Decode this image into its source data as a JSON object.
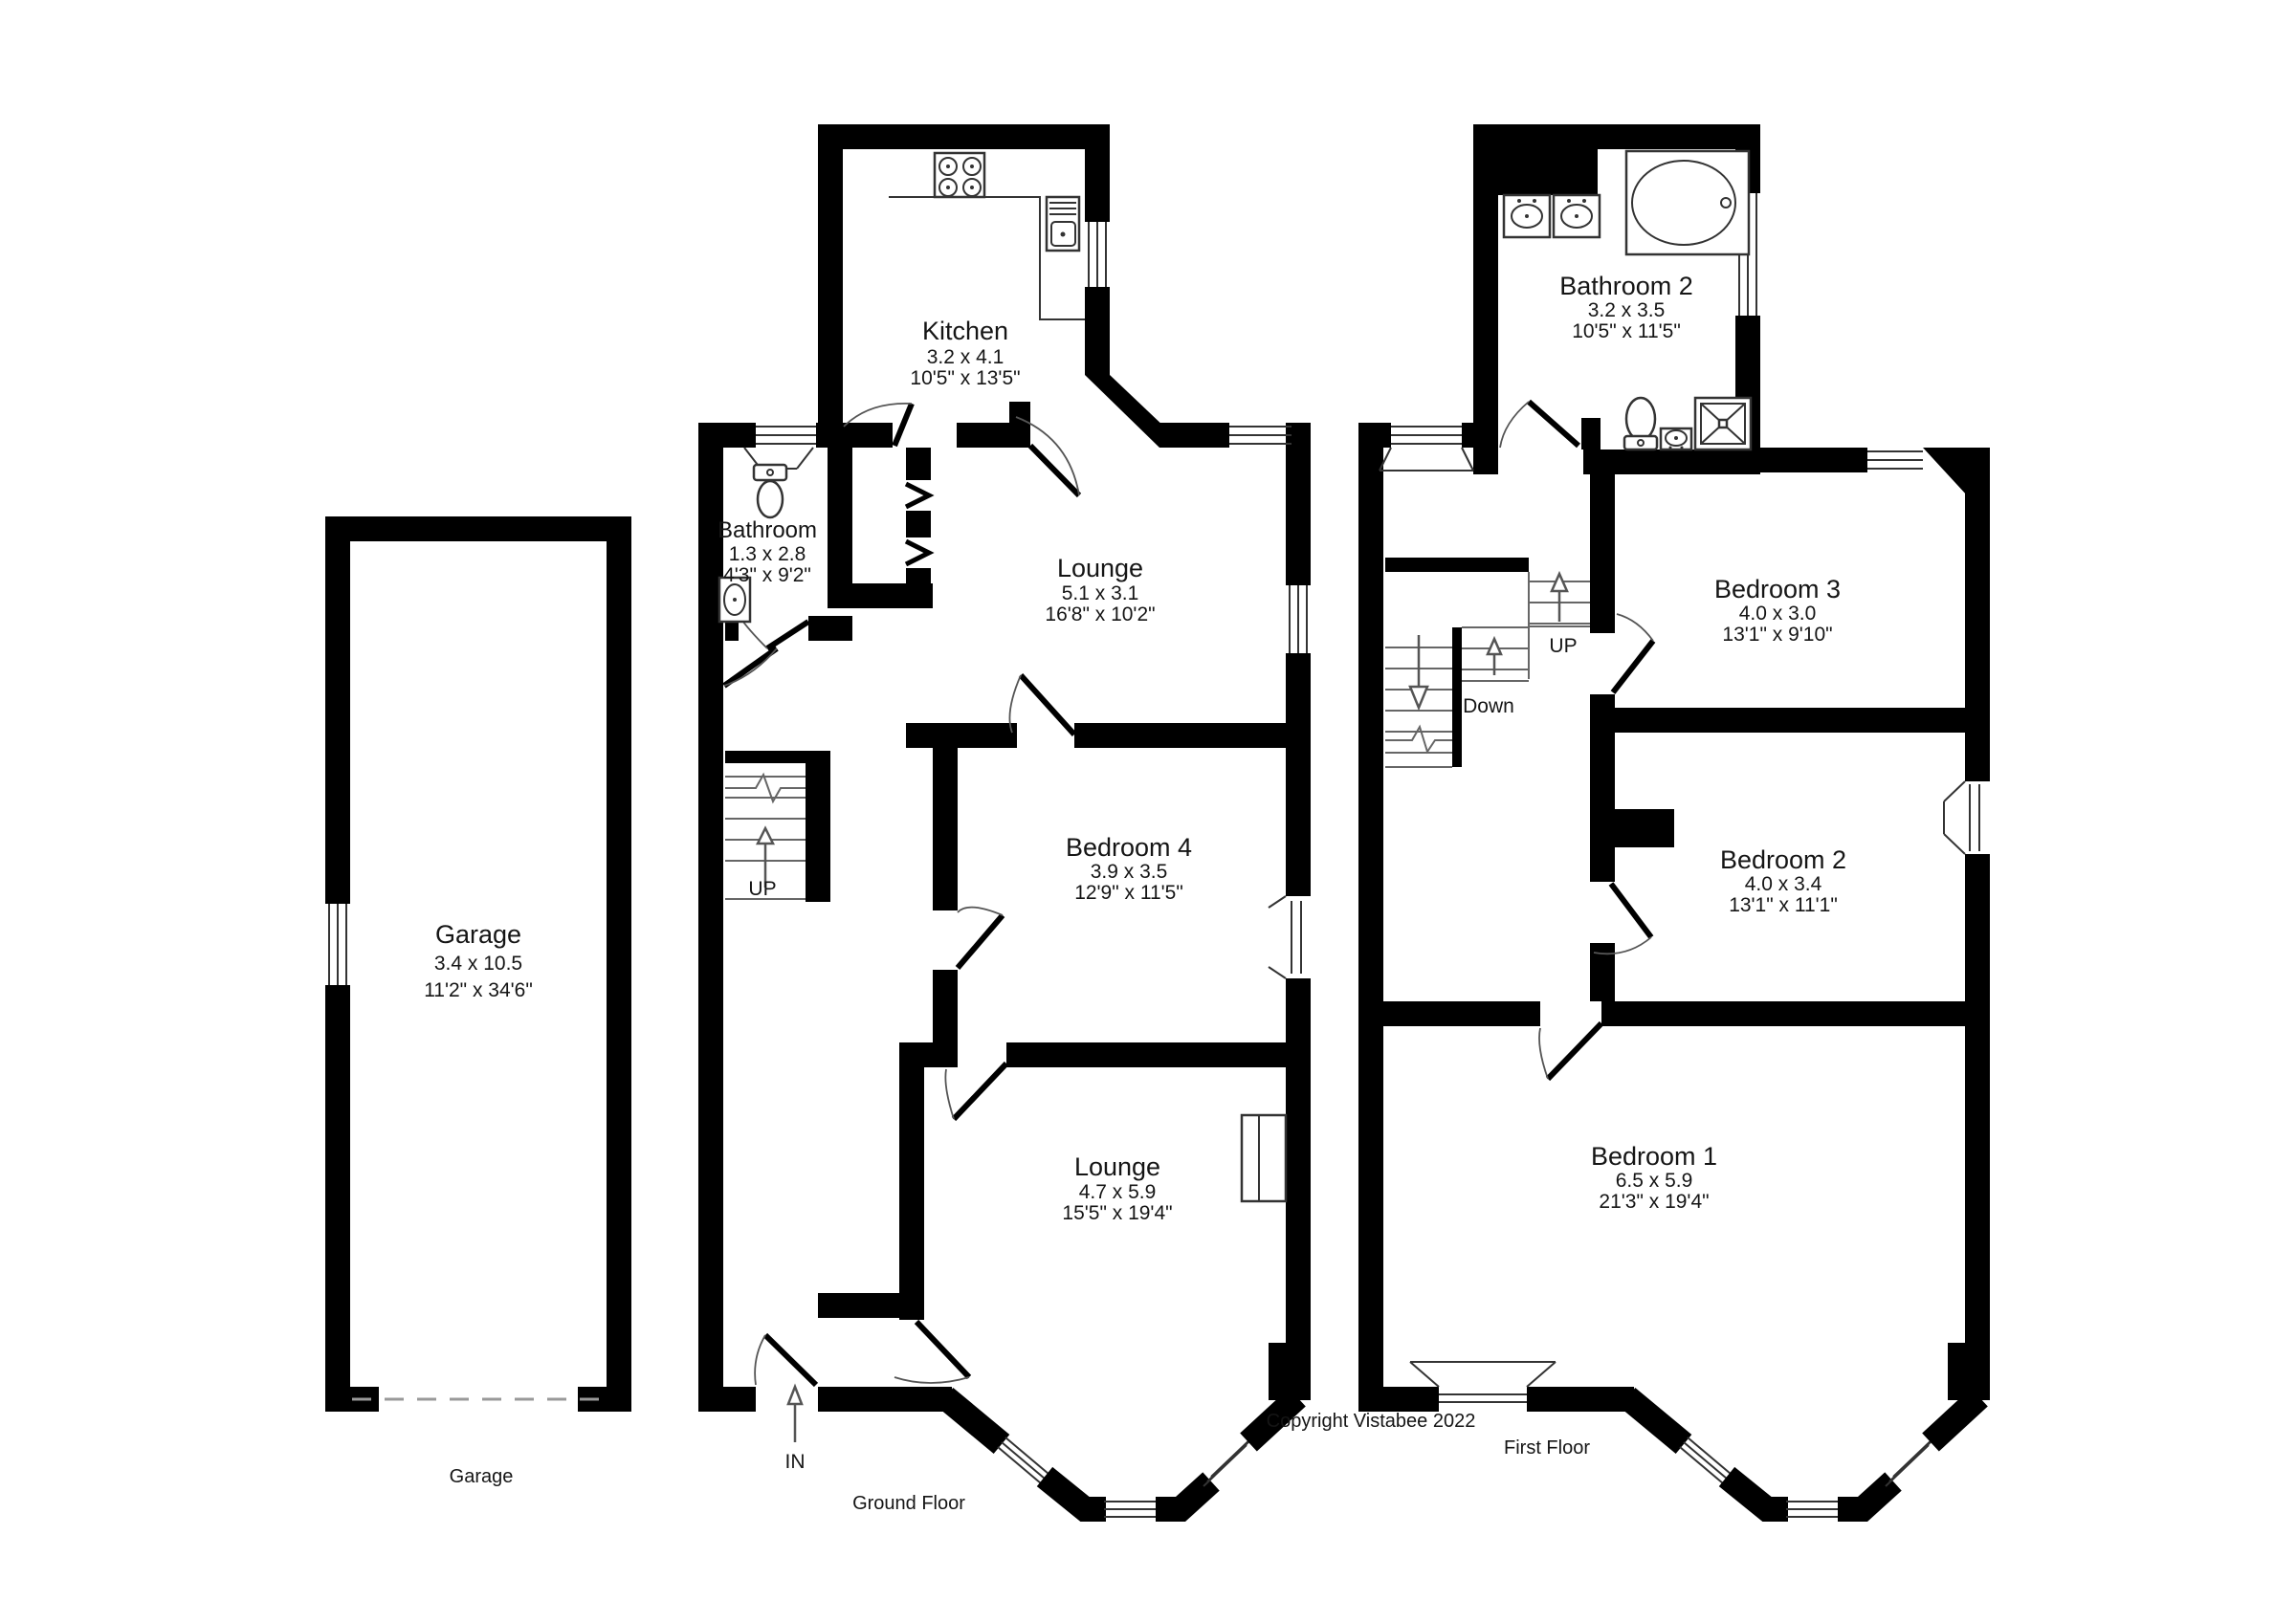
{
  "copyright": "Copyright Vistabee 2022",
  "garage_plan": {
    "floor_label": "Garage",
    "room": {
      "name": "Garage",
      "dims_m": "3.4 x 10.5",
      "dims_ft": "11'2\" x 34'6\""
    }
  },
  "ground_floor": {
    "floor_label": "Ground Floor",
    "entrance_label": "IN",
    "stairs_label": "UP",
    "rooms": [
      {
        "name": "Kitchen",
        "dims_m": "3.2 x 4.1",
        "dims_ft": "10'5\" x 13'5\""
      },
      {
        "name": "Bathroom",
        "dims_m": "1.3 x 2.8",
        "dims_ft": "4'3\" x 9'2\""
      },
      {
        "name": "Lounge",
        "dims_m": "5.1 x 3.1",
        "dims_ft": "16'8\" x 10'2\""
      },
      {
        "name": "Bedroom 4",
        "dims_m": "3.9 x 3.5",
        "dims_ft": "12'9\" x 11'5\""
      },
      {
        "name": "Lounge",
        "dims_m": "4.7 x 5.9",
        "dims_ft": "15'5\" x 19'4\""
      }
    ]
  },
  "first_floor": {
    "floor_label": "First Floor",
    "stairs_up_label": "UP",
    "stairs_down_label": "Down",
    "rooms": [
      {
        "name": "Bathroom 2",
        "dims_m": "3.2 x 3.5",
        "dims_ft": "10'5\" x 11'5\""
      },
      {
        "name": "Bedroom 3",
        "dims_m": "4.0 x 3.0",
        "dims_ft": "13'1\" x 9'10\""
      },
      {
        "name": "Bedroom 2",
        "dims_m": "4.0 x 3.4",
        "dims_ft": "13'1\" x 11'1\""
      },
      {
        "name": "Bedroom 1",
        "dims_m": "6.5 x 5.9",
        "dims_ft": "21'3\" x 19'4\""
      }
    ]
  }
}
